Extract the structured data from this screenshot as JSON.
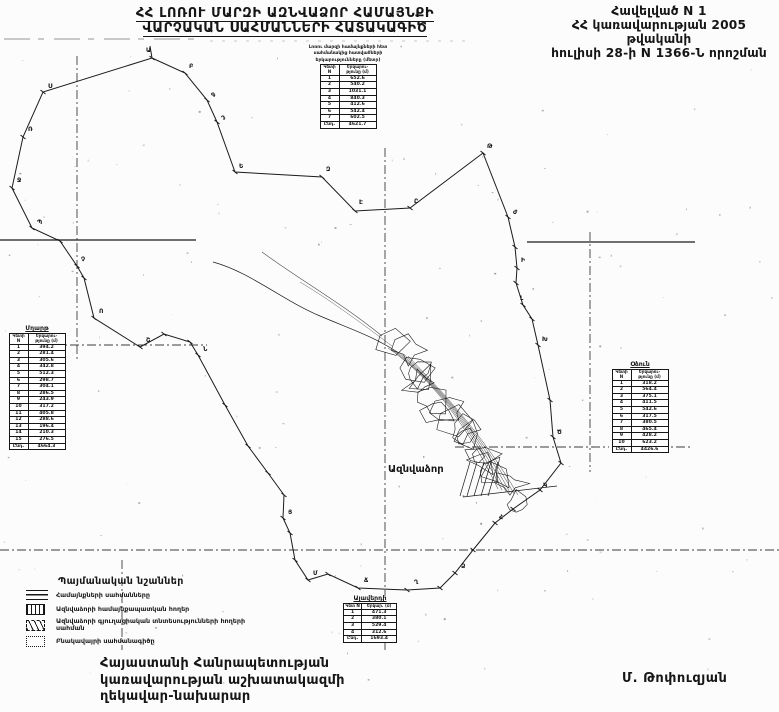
{
  "header": {
    "title_line1": "ՀՀ ԼՈՌՈՒ ՄԱՐԶԻ ԱԶՆՎԱՁՈՐ ՀԱՄԱՅՆՔԻ",
    "title_line2": "ՎԱՐՉԱԿԱՆ ՍԱՀՄԱՆՆԵՐԻ ՀԱՏԱԿԱԳԻԾ"
  },
  "annex": {
    "line1": "Հավելված N 1",
    "line2": "ՀՀ կառավարության 2005 թվականի",
    "line3": "հուլիսի 28-ի N 1366-Ն որոշման"
  },
  "map": {
    "village_label": "Ազնվաձոր",
    "point_labels": [
      {
        "ch": "Ա",
        "x": 146,
        "y": 52
      },
      {
        "ch": "Բ",
        "x": 189,
        "y": 68
      },
      {
        "ch": "Գ",
        "x": 211,
        "y": 97
      },
      {
        "ch": "Դ",
        "x": 221,
        "y": 120
      },
      {
        "ch": "Ե",
        "x": 239,
        "y": 168
      },
      {
        "ch": "Զ",
        "x": 326,
        "y": 171
      },
      {
        "ch": "Է",
        "x": 359,
        "y": 204
      },
      {
        "ch": "Ը",
        "x": 414,
        "y": 203
      },
      {
        "ch": "Թ",
        "x": 487,
        "y": 148
      },
      {
        "ch": "Ժ",
        "x": 513,
        "y": 214
      },
      {
        "ch": "Ի",
        "x": 521,
        "y": 262
      },
      {
        "ch": "Լ",
        "x": 520,
        "y": 300
      },
      {
        "ch": "Խ",
        "x": 542,
        "y": 341
      },
      {
        "ch": "Ծ",
        "x": 557,
        "y": 434
      },
      {
        "ch": "Կ",
        "x": 543,
        "y": 487
      },
      {
        "ch": "Հ",
        "x": 499,
        "y": 519
      },
      {
        "ch": "Ձ",
        "x": 461,
        "y": 568
      },
      {
        "ch": "Ղ",
        "x": 414,
        "y": 584
      },
      {
        "ch": "Ճ",
        "x": 364,
        "y": 582
      },
      {
        "ch": "Մ",
        "x": 313,
        "y": 575
      },
      {
        "ch": "Յ",
        "x": 288,
        "y": 514
      },
      {
        "ch": "Ն",
        "x": 203,
        "y": 351
      },
      {
        "ch": "Շ",
        "x": 146,
        "y": 342
      },
      {
        "ch": "Ո",
        "x": 99,
        "y": 313
      },
      {
        "ch": "Չ",
        "x": 81,
        "y": 261
      },
      {
        "ch": "Պ",
        "x": 37,
        "y": 224
      },
      {
        "ch": "Ջ",
        "x": 17,
        "y": 182
      },
      {
        "ch": "Ռ",
        "x": 28,
        "y": 131
      },
      {
        "ch": "Ս",
        "x": 48,
        "y": 88
      }
    ]
  },
  "tables": {
    "top": {
      "caption_lines": [
        "Լոռու մարզի համայնքների հետ",
        "սահմանակից հատվածների",
        "երկարությունները (մետր)"
      ],
      "col_point": "Կետի N",
      "col_length": "Երկարու- թյունը (մ)",
      "rows": [
        [
          "1",
          "652.6"
        ],
        [
          "2",
          "540.2"
        ],
        [
          "3",
          "1031.1"
        ],
        [
          "4",
          "840.3"
        ],
        [
          "5",
          "412.6"
        ],
        [
          "6",
          "542.4"
        ],
        [
          "7",
          "602.5"
        ]
      ],
      "total": [
        "Ընդ.",
        "4621.7"
      ]
    },
    "left": {
      "title": "Մղարթ",
      "col_point": "Կետի N",
      "col_length": "Երկարու- թյունը (մ)",
      "rows": [
        [
          "1",
          "394.2"
        ],
        [
          "2",
          "281.4"
        ],
        [
          "3",
          "305.6"
        ],
        [
          "4",
          "342.8"
        ],
        [
          "5",
          "512.3"
        ],
        [
          "6",
          "298.7"
        ],
        [
          "7",
          "304.1"
        ],
        [
          "8",
          "286.5"
        ],
        [
          "9",
          "243.9"
        ],
        [
          "10",
          "317.2"
        ],
        [
          "11",
          "405.8"
        ],
        [
          "12",
          "288.6"
        ],
        [
          "13",
          "196.4"
        ],
        [
          "14",
          "210.3"
        ],
        [
          "15",
          "276.5"
        ]
      ],
      "total": [
        "Ընդ.",
        "4664.3"
      ]
    },
    "right": {
      "title": "Օձուն",
      "col_point": "Կետի N",
      "col_length": "Երկարու- թյունը (մ)",
      "rows": [
        [
          "1",
          "318.2"
        ],
        [
          "2",
          "564.4"
        ],
        [
          "3",
          "375.1"
        ],
        [
          "4",
          "411.5"
        ],
        [
          "5",
          "542.6"
        ],
        [
          "6",
          "317.5"
        ],
        [
          "7",
          "380.5"
        ],
        [
          "8",
          "465.4"
        ],
        [
          "9",
          "428.2"
        ],
        [
          "10",
          "623.2"
        ]
      ],
      "total": [
        "Ընդ.",
        "4426.6"
      ]
    },
    "bottom": {
      "title": "Ալավերդի",
      "col_point": "Կետ N",
      "col_length": "Երկար. (մ)",
      "rows": [
        [
          "1",
          "471.3"
        ],
        [
          "2",
          "380.1"
        ],
        [
          "3",
          "529.4"
        ],
        [
          "4",
          "312.6"
        ]
      ],
      "total": [
        "Ընդ.",
        "1693.4"
      ]
    }
  },
  "legend": {
    "title": "Պայմանական նշաններ",
    "items": [
      {
        "icon": "triple-line-icon",
        "label": "Համայնքների սահմանները"
      },
      {
        "icon": "hatched-box-icon",
        "label": "Ազնվաձորի համայնքապատկան հողեր"
      },
      {
        "icon": "marked-box-icon",
        "label": "Ազնվաձորի գյուղացիական տնտեսությունների հողերի սահման"
      },
      {
        "icon": "dotted-box-icon",
        "label": "Բնակավայրի սահմանագիծը"
      }
    ]
  },
  "footer": {
    "org_lines": [
      "Հայաստանի Հանրապետության",
      "կառավարության աշխատակազմի",
      "ղեկավար-նախարար"
    ],
    "signer": "Մ. Թոփուզյան"
  },
  "colors": {
    "ink": "#1b1b1b",
    "paper": "#fcfcfc"
  }
}
